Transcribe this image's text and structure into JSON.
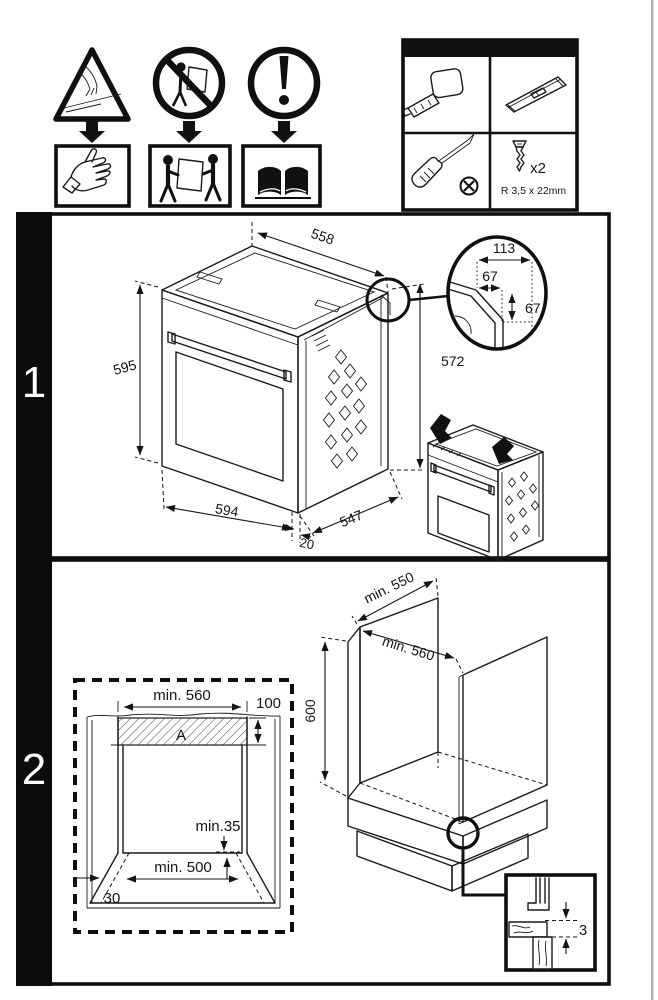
{
  "page": {
    "type": "oven-installation-manual-page"
  },
  "safety": {
    "hazards": [
      {
        "icon": "sharp-edge-cut-warning-icon"
      },
      {
        "icon": "no-single-person-carry-icon"
      },
      {
        "icon": "attention-icon"
      }
    ],
    "requirements": [
      {
        "icon": "wear-gloves-icon"
      },
      {
        "icon": "two-person-carry-icon"
      },
      {
        "icon": "read-manual-icon"
      }
    ]
  },
  "tools": {
    "items": [
      "tape-measure",
      "spirit-level",
      "phillips-screwdriver",
      "mounting-screws"
    ],
    "screw_qty": "x2",
    "screw_spec": "R 3,5 x 22mm"
  },
  "steps": [
    {
      "number": "1"
    },
    {
      "number": "2"
    }
  ],
  "step1": {
    "dims": {
      "top_width": "558",
      "front_height": "595",
      "bottom_width": "594",
      "front_lip": "20",
      "depth": "547",
      "rear_height": "572"
    },
    "detail": {
      "width": "113",
      "offset_width": "67",
      "offset_height": "67"
    }
  },
  "step2": {
    "niche": {
      "width": "min. 560",
      "vent_height": "100",
      "vent_label": "A",
      "base_clearance": "min.35",
      "base_width": "min. 500",
      "plinth_depth": "30"
    },
    "cabinet": {
      "depth": "min. 550",
      "width": "min. 560",
      "height": "600",
      "rear_gap": "3"
    }
  }
}
